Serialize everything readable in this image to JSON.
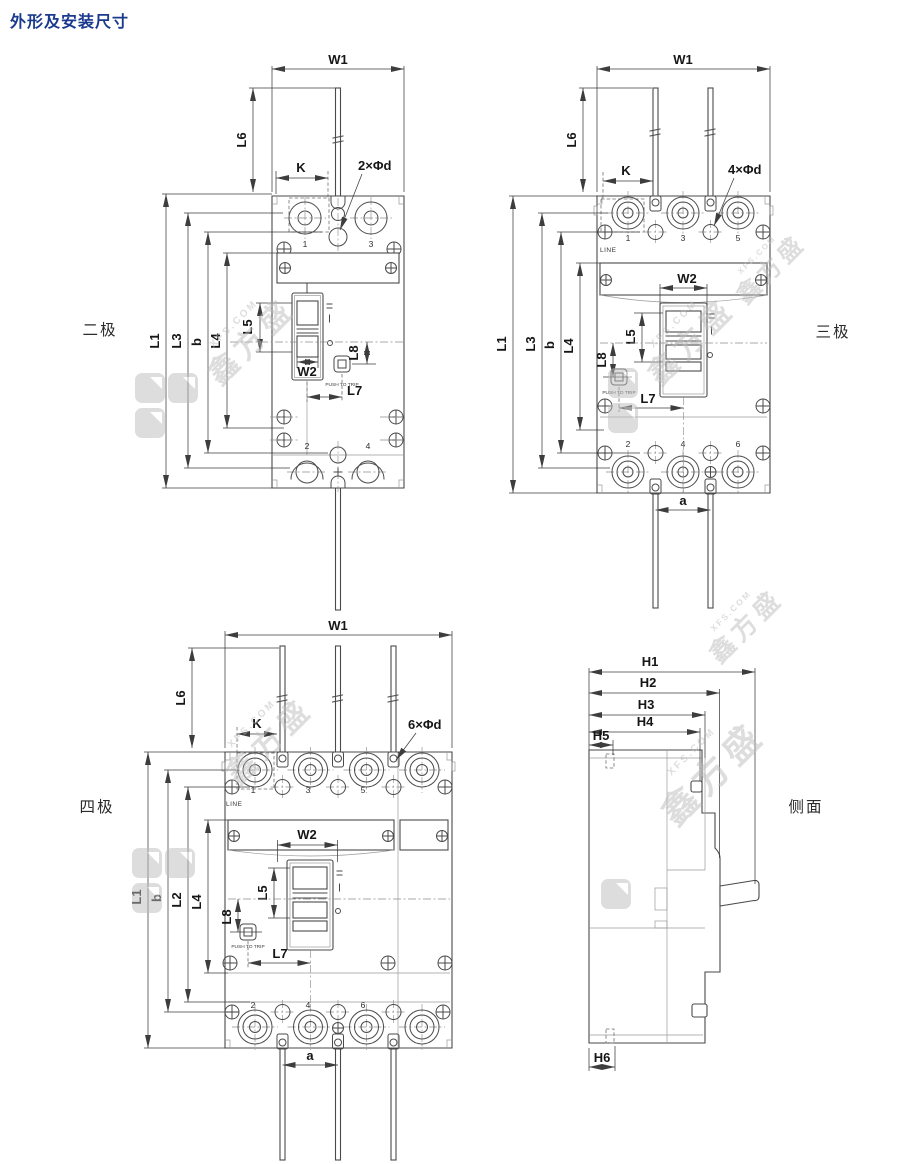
{
  "title": "外形及安装尺寸",
  "watermark": {
    "en": "XFS.COM",
    "cn": "鑫方盛"
  },
  "labels": {
    "push_to_trip": "PUSH TO TRIP",
    "line": "LINE"
  },
  "views": {
    "two_pole": {
      "name": "二极",
      "dims": {
        "w1": "W1",
        "l6": "L6",
        "k": "K",
        "holes": "2×Φd",
        "l1": "L1",
        "l3": "L3",
        "b": "b",
        "l4": "L4",
        "l5": "L5",
        "w2": "W2",
        "l8": "L8",
        "l7": "L7"
      },
      "terminals_top": [
        "1",
        "3"
      ],
      "terminals_bottom": [
        "2",
        "4"
      ]
    },
    "three_pole": {
      "name": "三极",
      "dims": {
        "w1": "W1",
        "l6": "L6",
        "k": "K",
        "holes": "4×Φd",
        "l1": "L1",
        "l3": "L3",
        "b": "b",
        "l4": "L4",
        "l5": "L5",
        "w2": "W2",
        "l8": "L8",
        "l7": "L7",
        "a": "a"
      },
      "terminals_top": [
        "1",
        "3",
        "5"
      ],
      "terminals_bottom": [
        "2",
        "4",
        "6"
      ]
    },
    "four_pole": {
      "name": "四极",
      "dims": {
        "w1": "W1",
        "l6": "L6",
        "k": "K",
        "holes": "6×Φd",
        "w2": "W2",
        "l1": "L1",
        "b": "b",
        "l2": "L2",
        "l4": "L4",
        "l5": "L5",
        "l8": "L8",
        "l7": "L7",
        "a": "a"
      },
      "terminals_top": [
        "1",
        "3",
        "5"
      ],
      "terminals_bottom": [
        "2",
        "4",
        "6"
      ]
    },
    "side": {
      "name": "侧面",
      "dims": {
        "h1": "H1",
        "h2": "H2",
        "h3": "H3",
        "h4": "H4",
        "h5": "H5",
        "h6": "H6"
      }
    }
  }
}
